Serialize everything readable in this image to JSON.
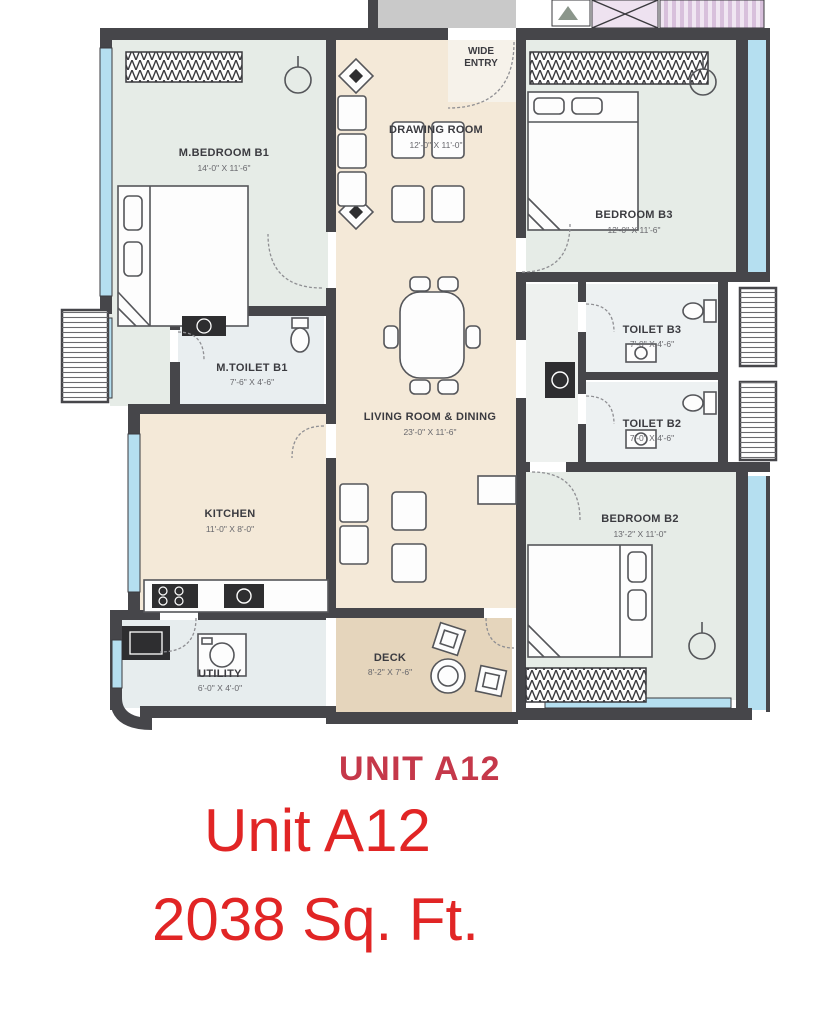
{
  "plan": {
    "entry": {
      "line1": "WIDE",
      "line2": "ENTRY"
    },
    "rooms": [
      {
        "id": "m-bedroom-b1",
        "label": "M.BEDROOM B1",
        "dims": "14'-0\" X 11'-6\""
      },
      {
        "id": "drawing-room",
        "label": "DRAWING ROOM",
        "dims": "12'-0\" X 11'-0\""
      },
      {
        "id": "bedroom-b3",
        "label": "BEDROOM B3",
        "dims": "12'-0\" X 11'-6\""
      },
      {
        "id": "m-toilet-b1",
        "label": "M.TOILET B1",
        "dims": "7'-6\" X 4'-6\""
      },
      {
        "id": "living-dining",
        "label": "LIVING ROOM & DINING",
        "dims": "23'-0\" X 11'-6\""
      },
      {
        "id": "toilet-b3",
        "label": "TOILET B3",
        "dims": "7'-0\" X 4'-6\""
      },
      {
        "id": "toilet-b2",
        "label": "TOILET B2",
        "dims": "7'-0\" X 4'-6\""
      },
      {
        "id": "kitchen",
        "label": "KITCHEN",
        "dims": "11'-0\" X 8'-0\""
      },
      {
        "id": "utility",
        "label": "UTILITY",
        "dims": "6'-0\" X 4'-0\""
      },
      {
        "id": "deck",
        "label": "DECK",
        "dims": "8'-2\" X 7'-6\""
      },
      {
        "id": "bedroom-b2",
        "label": "BEDROOM B2",
        "dims": "13'-2\" X 11'-0\""
      }
    ]
  },
  "footer": {
    "unit_label": "UNIT A12",
    "unit_title": "Unit A12",
    "area": "2038 Sq. Ft."
  },
  "colors": {
    "wall": "#46464a",
    "bedroom_fill": "#e6ece7",
    "living_fill": "#f4e9d8",
    "deck_fill": "#e5d5bc",
    "toilet_fill": "#edf1f2",
    "window_blue": "#b5dff0",
    "corridor_gray": "#c9c9c9",
    "lavender": "#eadcec",
    "unit_label_red": "#c5384a",
    "title_red": "#e12525"
  }
}
